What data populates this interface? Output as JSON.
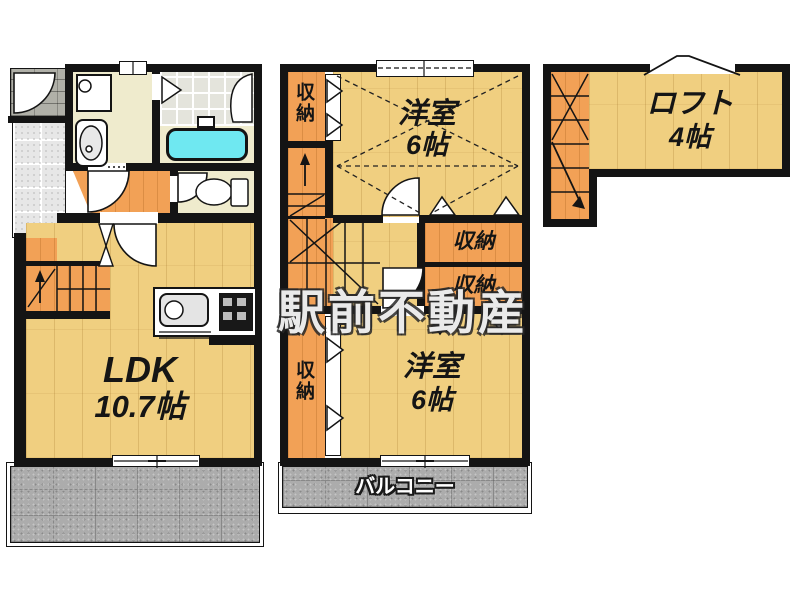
{
  "watermark": "駅前不動産",
  "floor1": {
    "ldk": {
      "name": "LDK",
      "size": "10.7帖"
    }
  },
  "floor2": {
    "upper_room": {
      "name": "洋室",
      "size": "6帖"
    },
    "lower_room": {
      "name": "洋室",
      "size": "6帖"
    },
    "closet_upper_left": "収納",
    "closet_right_upper": "収納",
    "closet_right_lower": "収納",
    "closet_lower_left": "収納",
    "balcony": "バルコニー"
  },
  "loft": {
    "room": {
      "name": "ロフト",
      "size": "4帖"
    }
  },
  "colors": {
    "wall": "#141414",
    "wood_floor": "#f0cf80",
    "orange_floor": "#f2a156",
    "bathtub": "#6fe8f1",
    "outdoor_tile_gray": "#acacac",
    "washroom_beige": "#efebcd"
  }
}
